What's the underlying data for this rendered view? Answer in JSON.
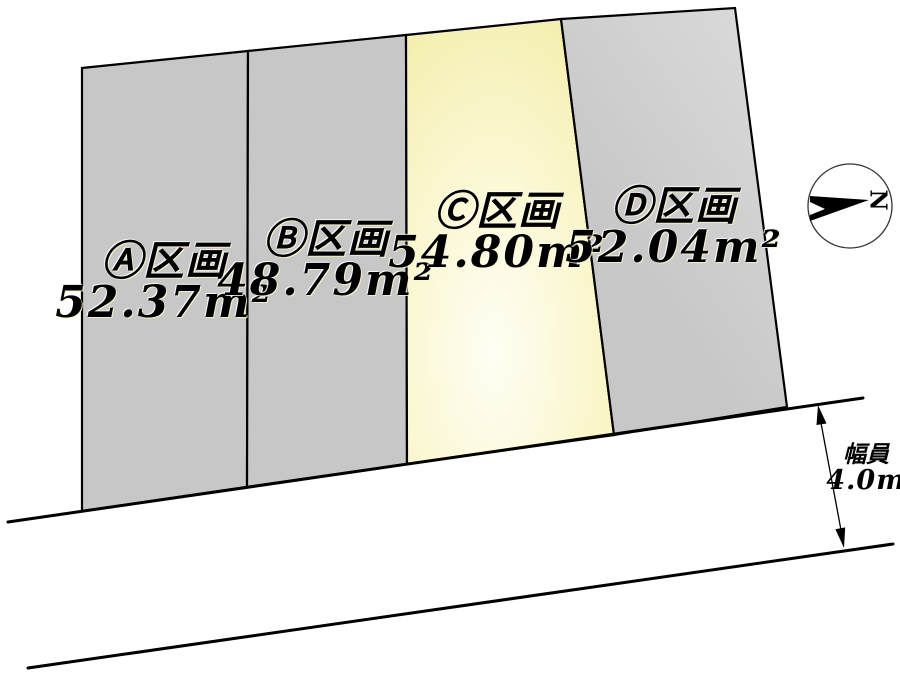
{
  "colors": {
    "background": "#ffffff",
    "line": "#000000",
    "plot_gray": "#c7c7c7",
    "plot_d_light": "#dadada",
    "highlight_center": "#fffef4",
    "highlight_mid": "#f9f5c8",
    "highlight_edge": "#f0ea9c"
  },
  "plots": [
    {
      "id": "A",
      "label": "Ⓐ区画",
      "area": "52.37m²",
      "highlighted": false
    },
    {
      "id": "B",
      "label": "Ⓑ区画",
      "area": "48.79m²",
      "highlighted": false
    },
    {
      "id": "C",
      "label": "Ⓒ区画",
      "area": "54.80m²",
      "highlighted": true
    },
    {
      "id": "D",
      "label": "Ⓓ区画",
      "area": "52.04m²",
      "highlighted": false
    }
  ],
  "road": {
    "width_label": "幅員",
    "width_value": "4.0m"
  },
  "compass": {
    "north_letter": "N"
  }
}
